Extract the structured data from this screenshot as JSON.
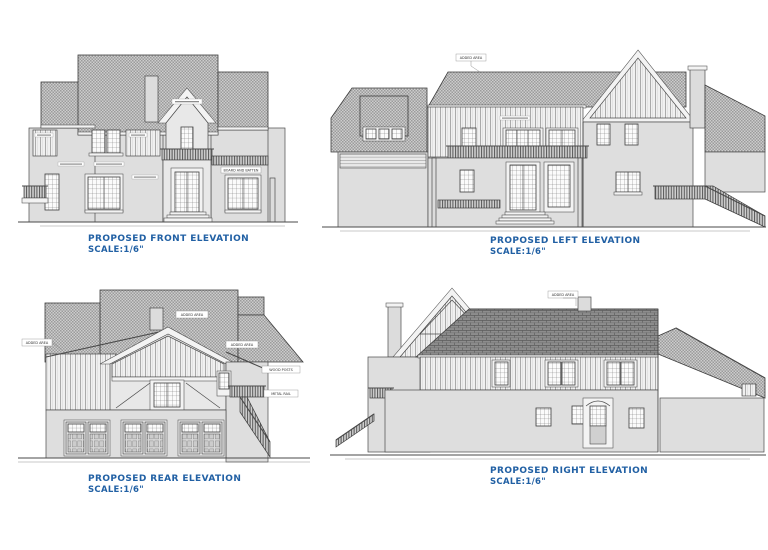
{
  "page": {
    "background": "#ffffff"
  },
  "colors": {
    "title_text": "#2160a4",
    "line": "#4a4a4a",
    "roof_light": "#cdcdcd",
    "roof_dark": "#8d8d8d",
    "wall": "#dedede"
  },
  "figures": {
    "front": {
      "title": "PROPOSED FRONT ELEVATION",
      "scale": "SCALE:1/6\""
    },
    "left": {
      "title": "PROPOSED LEFT ELEVATION",
      "scale": "SCALE:1/6\""
    },
    "rear": {
      "title": "PROPOSED REAR ELEVATION",
      "scale": "SCALE:1/6\""
    },
    "right": {
      "title": "PROPOSED RIGHT ELEVATION",
      "scale": "SCALE:1/6\""
    }
  },
  "annotations": {
    "added_area": "ADDED AREA",
    "board_and_batten": "BOARD AND BATTEN",
    "wood_posts": "WOOD POSTS",
    "metal_rail": "METAL RAIL"
  }
}
